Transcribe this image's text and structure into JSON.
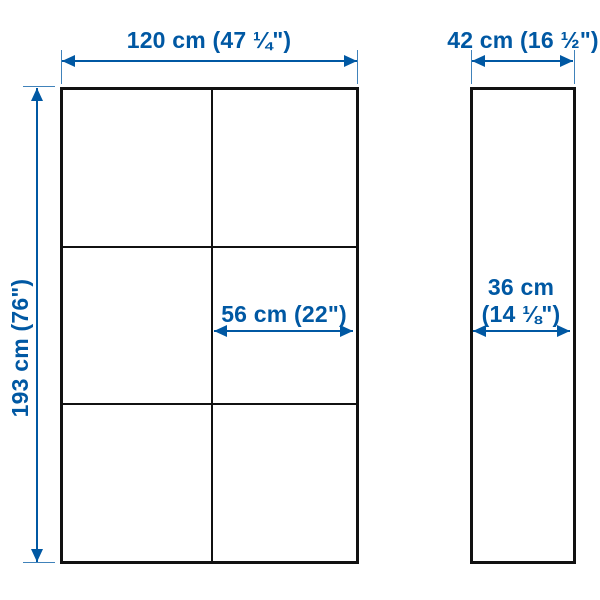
{
  "diagram": {
    "type": "product-dimension-diagram",
    "accent_color": "#0058A3",
    "outline_color": "#111111",
    "front_view": {
      "width_label": "120 cm (47 ¼\")",
      "height_label": "193 cm (76\")",
      "inner_width_label": "56 cm (22\")",
      "grid": {
        "columns": 2,
        "rows": 3
      }
    },
    "side_view": {
      "depth_label": "42 cm (16 ½\")",
      "inner_depth_label_line1": "36 cm",
      "inner_depth_label_line2": "(14 ⅛\")"
    }
  }
}
